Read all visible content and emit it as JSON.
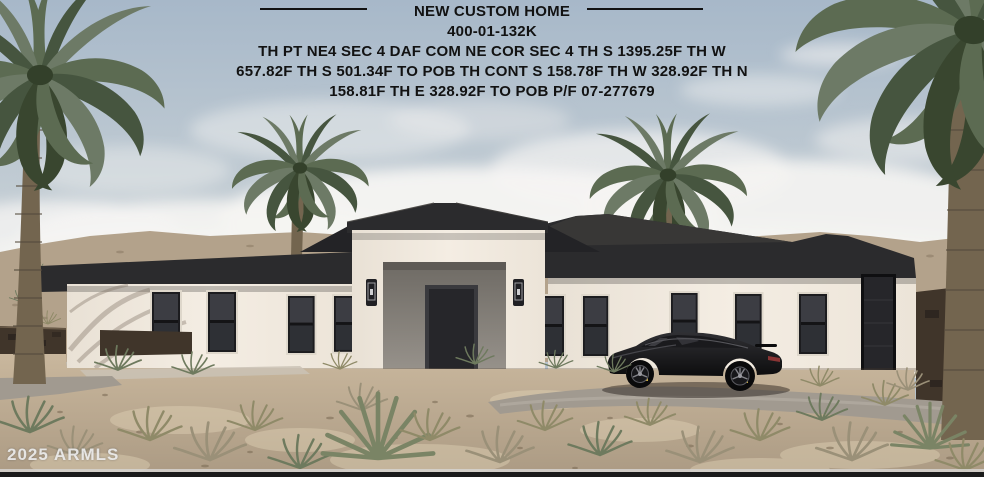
{
  "overlay": {
    "title": "NEW CUSTOM HOME",
    "parcel_id": "400-01-132K",
    "legal_lines": [
      "TH PT NE4 SEC 4 DAF COM NE COR SEC 4 TH S 1395.25F TH W",
      "657.82F TH S 501.34F TO POB TH CONT S 158.78F TH W 328.92F TH N",
      "158.81F TH E 328.92F TO POB P/F 07-277679"
    ]
  },
  "watermark": {
    "text": "2025 ARMLS"
  },
  "colors": {
    "sky_top": "#a7b8c9",
    "sky_horizon": "#d8dad8",
    "cloud": "#f5f4f2",
    "hill": "#b3a28b",
    "rock": "#40352a",
    "roof": "#2b2b2d",
    "roof_facet": "#3a3937",
    "wall": "#f2ebe1",
    "window": "#36363b",
    "door": "#26262a",
    "entry_recess": "#8f8a83",
    "dirt": "#c2b097",
    "road": "#a19a90",
    "car": "#141416",
    "brake_caliper": "#c9aa3a",
    "palm_frond": "#5c6b52",
    "palm_trunk": "#73654f",
    "text": "#121212",
    "watermark_text": "#ebebeb",
    "bottom_bar": "#1b1b1b"
  }
}
